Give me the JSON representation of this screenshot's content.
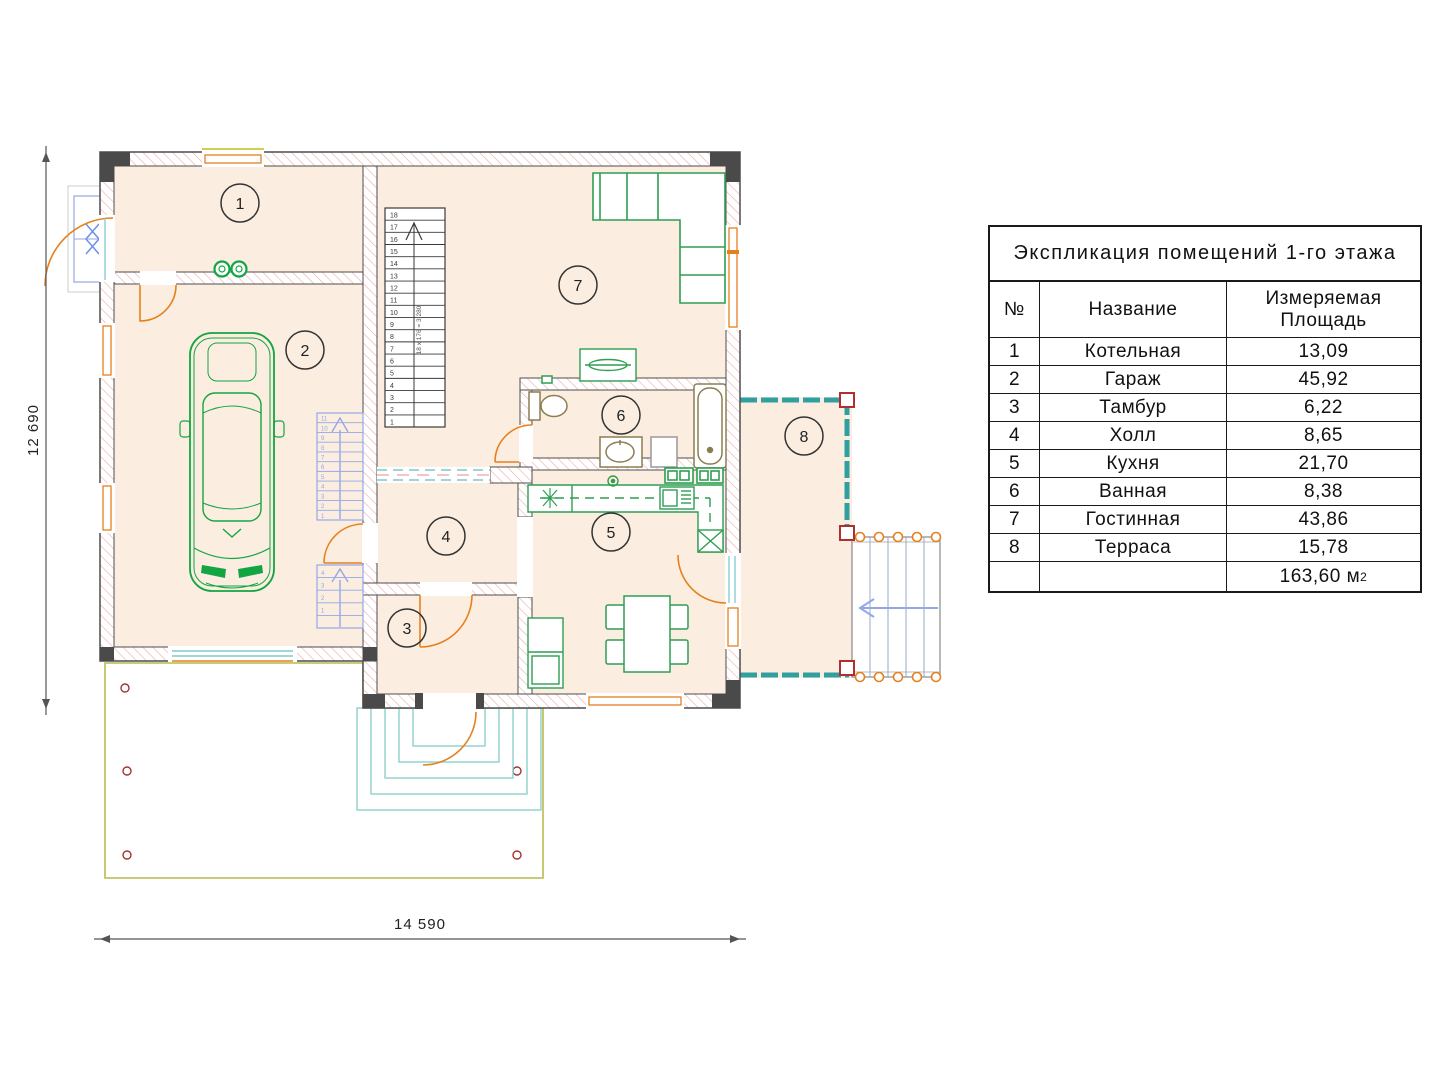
{
  "plan": {
    "dim_height": "12 690",
    "dim_width": "14 590",
    "rooms": [
      {
        "number": "1",
        "name": "Котельная"
      },
      {
        "number": "2",
        "name": "Гараж"
      },
      {
        "number": "3",
        "name": "Тамбур"
      },
      {
        "number": "4",
        "name": "Холл"
      },
      {
        "number": "5",
        "name": "Кухня"
      },
      {
        "number": "6",
        "name": "Ванная"
      },
      {
        "number": "7",
        "name": "Гостинная"
      },
      {
        "number": "8",
        "name": "Терраса"
      }
    ],
    "main_stair_label": "18 x 176 = 3,280",
    "main_stair_numbers": [
      "18",
      "17",
      "16",
      "15",
      "14",
      "13",
      "12",
      "11",
      "10",
      "9",
      "8",
      "7",
      "6",
      "5",
      "4",
      "3",
      "2",
      "1"
    ],
    "garage_stair_upper_numbers": [
      "11",
      "10",
      "9",
      "8",
      "7",
      "6",
      "5",
      "4",
      "3",
      "2",
      "1"
    ],
    "garage_stair_lower_numbers": [
      "4",
      "3",
      "2",
      "1",
      ""
    ]
  },
  "legend_table": {
    "title": "Экспликация помещений 1-го этажа",
    "col_num": "№",
    "col_name": "Название",
    "col_area_line1": "Измеряемая",
    "col_area_line2": "Площадь",
    "rows": [
      {
        "num": "1",
        "name": "Котельная",
        "area": "13,09"
      },
      {
        "num": "2",
        "name": "Гараж",
        "area": "45,92"
      },
      {
        "num": "3",
        "name": "Тамбур",
        "area": "6,22"
      },
      {
        "num": "4",
        "name": "Холл",
        "area": "8,65"
      },
      {
        "num": "5",
        "name": "Кухня",
        "area": "21,70"
      },
      {
        "num": "6",
        "name": "Ванная",
        "area": "8,38"
      },
      {
        "num": "7",
        "name": "Гостинная",
        "area": "43,86"
      },
      {
        "num": "8",
        "name": "Терраса",
        "area": "15,78"
      }
    ],
    "total_value": "163,60 м",
    "total_sup": "2"
  },
  "colors": {
    "room_fill": "#fbeee0",
    "wall_hatch": "#f0abab",
    "wall_stroke": "#4d4d4d",
    "furniture_green": "#2e9e52",
    "car_green": "#12a542",
    "door_orange": "#e6801f",
    "terrace_teal": "#2f9fa0",
    "stair_blue": "#94a7e6",
    "driveway_yellow": "#b9ba4d",
    "marker_red": "#a33333",
    "fixture_khaki": "#8b7d52"
  }
}
